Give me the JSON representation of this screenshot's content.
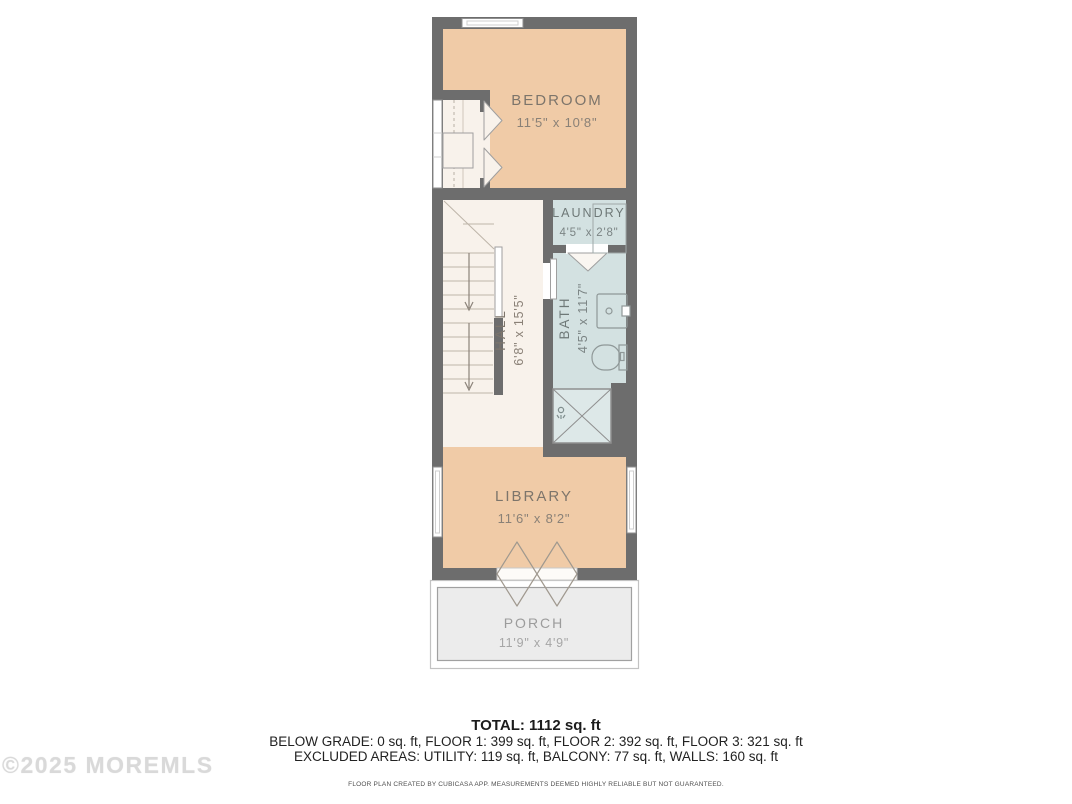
{
  "plan": {
    "rooms": {
      "bedroom": {
        "name": "BEDROOM",
        "dims": "11'5\" x 10'8\""
      },
      "laundry": {
        "name": "LAUNDRY",
        "dims": "4'5\" x 2'8\""
      },
      "hall": {
        "name": "HALL",
        "dims": "6'8\" x 15'5\""
      },
      "bath": {
        "name": "BATH",
        "dims": "4'5\" x 11'7\""
      },
      "library": {
        "name": "LIBRARY",
        "dims": "11'6\" x 8'2\""
      },
      "porch": {
        "name": "PORCH",
        "dims": "11'9\" x 4'9\""
      }
    },
    "colors": {
      "wall": "#6d6d6d",
      "room_tan": "#f0cba7",
      "room_blue": "#d3e1e1",
      "hall_floor": "#f8f2eb",
      "porch_floor": "#ececec",
      "shower_floor": "#dde8e8",
      "label_tan": "#7d756b",
      "label_blue": "#6e7877",
      "label_porch": "#9c9c9c"
    }
  },
  "summary": {
    "total": "TOTAL: 1112 sq. ft",
    "floors": "BELOW GRADE: 0 sq. ft, FLOOR 1: 399 sq. ft, FLOOR 2: 392 sq. ft, FLOOR 3: 321 sq. ft",
    "excluded": "EXCLUDED AREAS: UTILITY: 119 sq. ft, BALCONY: 77 sq. ft, WALLS: 160 sq. ft"
  },
  "disclaimer": "FLOOR PLAN CREATED BY CUBICASA APP. MEASUREMENTS DEEMED HIGHLY RELIABLE BUT NOT GUARANTEED.",
  "watermark": "©2025 MOREMLS"
}
